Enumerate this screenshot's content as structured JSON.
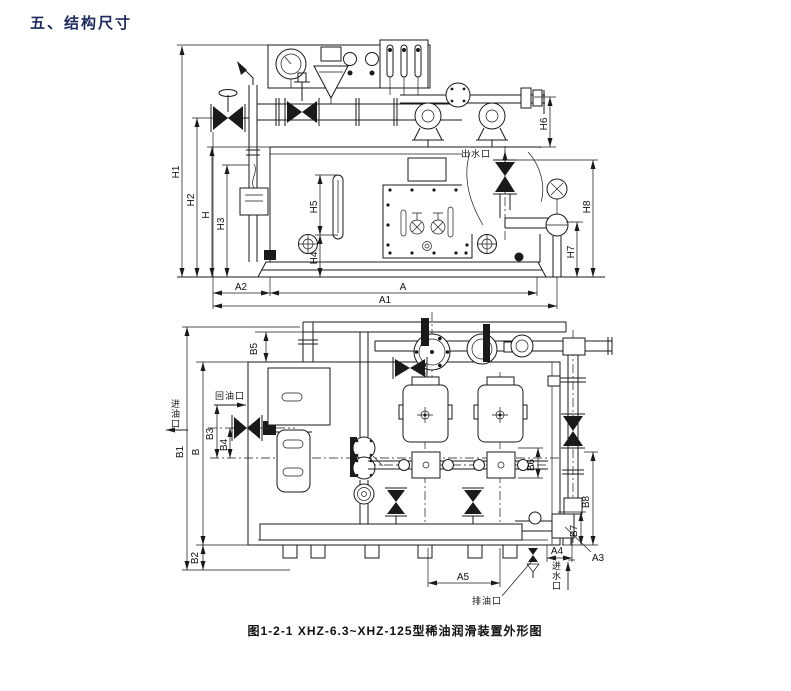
{
  "page": {
    "heading": "五、结构尺寸",
    "caption": "图1-2-1  XHZ-6.3~XHZ-125型稀油润滑装置外形图"
  },
  "front_view": {
    "dims": {
      "h1": "H1",
      "h2": "H2",
      "h": "H",
      "h3": "H3",
      "h4": "H4",
      "h5": "H5",
      "h6": "H6",
      "h7": "H7",
      "h8": "H8",
      "a": "A",
      "a1": "A1",
      "a2": "A2"
    },
    "ports": {
      "water_outlet": "出水口"
    }
  },
  "plan_view": {
    "dims": {
      "b1": "B1",
      "b": "B",
      "b2": "B2",
      "b3": "B3",
      "b4": "B4",
      "b5": "B5",
      "b6": "B6",
      "b7": "B7",
      "b8": "B8",
      "a3": "A3",
      "a4": "A4",
      "a5": "A5"
    },
    "ports": {
      "oil_return": "回油口",
      "oil_inlet": "进油口",
      "oil_drain": "排油口",
      "water_inlet": "进水口"
    }
  }
}
